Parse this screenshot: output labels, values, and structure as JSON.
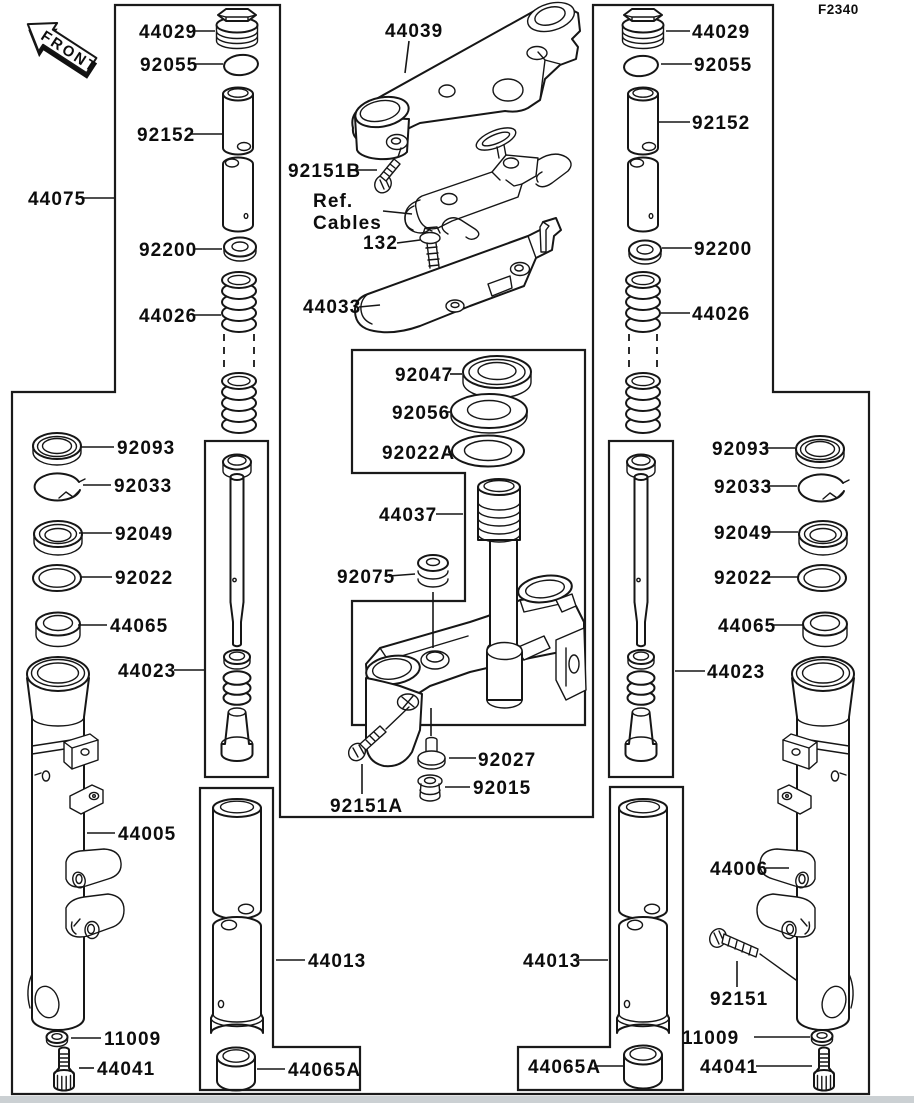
{
  "sheet": {
    "code": "F2340",
    "front_marker": "FRONT"
  },
  "ref_note": {
    "line1": "Ref.",
    "line2": "Cables"
  },
  "parts": {
    "fork_assembly": "44075",
    "top_plug": "44029",
    "o_ring": "92055",
    "collar": "92152",
    "washer_92200": "92200",
    "spring": "44026",
    "upper_clamp": "44039",
    "bolt_92151b": "92151B",
    "bolt_132": "132",
    "bracket_44033": "44033",
    "bearing_92047": "92047",
    "race_92056": "92056",
    "washer_92022a": "92022A",
    "stem_44037": "44037",
    "damper_92075": "92075",
    "collar_92027": "92027",
    "grommet_92015": "92015",
    "bolt_92151a": "92151A",
    "seal_92093": "92093",
    "ring_92033": "92033",
    "oil_seal_92049": "92049",
    "washer_92022": "92022",
    "bushing_44065": "44065",
    "cylinder_44023": "44023",
    "outer_tube_left": "44005",
    "outer_tube_right": "44006",
    "inner_tube_44013": "44013",
    "bushing_44065a": "44065A",
    "washer_11009": "11009",
    "screw_44041": "44041",
    "bolt_92151": "92151"
  }
}
